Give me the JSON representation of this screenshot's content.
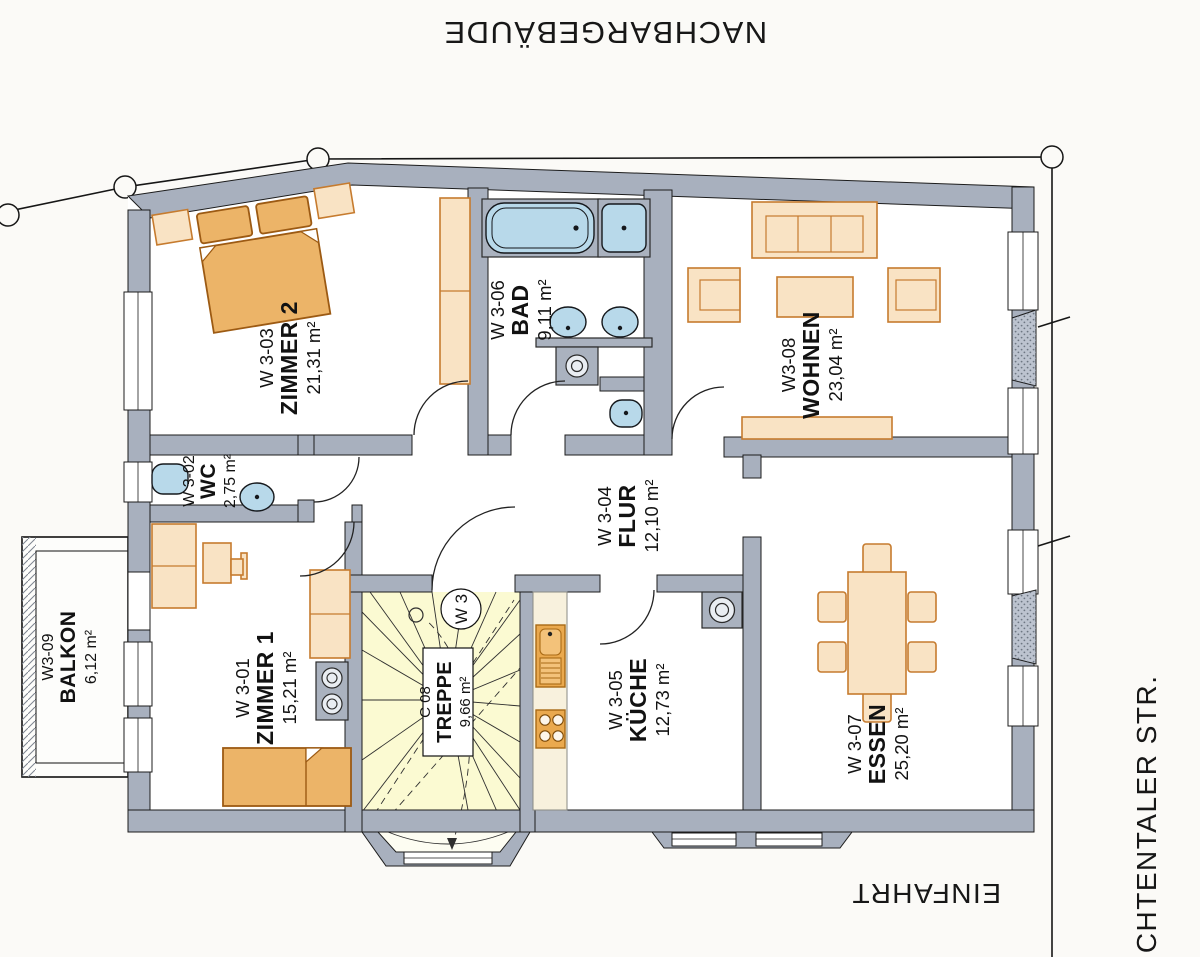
{
  "site": {
    "neighbor_label": "NACHBARGEBÄUDE",
    "street_label": "LICHTENTALER STR.",
    "driveway_label": "EINFAHRT"
  },
  "unit": {
    "badge": "W 3"
  },
  "rooms": {
    "zimmer2": {
      "code": "W 3-03",
      "name": "ZIMMER 2",
      "area": "21,31 m²"
    },
    "bad": {
      "code": "W 3-06",
      "name": "BAD",
      "area": "9,11 m²"
    },
    "wohnen": {
      "code": "W3-08",
      "name": "WOHNEN",
      "area": "23,04 m²"
    },
    "wc": {
      "code": "W 3-02",
      "name": "WC",
      "area": "2,75 m²"
    },
    "flur": {
      "code": "W 3-04",
      "name": "FLUR",
      "area": "12,10 m²"
    },
    "zimmer1": {
      "code": "W 3-01",
      "name": "ZIMMER 1",
      "area": "15,21 m²"
    },
    "treppe": {
      "code": "C 08",
      "name": "TREPPE",
      "area": "9,66 m²"
    },
    "kueche": {
      "code": "W 3-05",
      "name": "KÜCHE",
      "area": "12,73 m²"
    },
    "essen": {
      "code": "W 3-07",
      "name": "ESSEN",
      "area": "25,20 m²"
    },
    "balkon": {
      "code": "W3-09",
      "name": "BALKON",
      "area": "6,12 m²"
    }
  },
  "colors": {
    "paper": "#fbfaf7",
    "wall": "#a8b0be",
    "wall-dark": "#bcc3cf",
    "furn-fill": "#f9e3c4",
    "furn-stroke": "#c67b2e",
    "bed-fill": "#ecb468",
    "bed-stroke": "#9c5a13",
    "blue-fill": "#b8d9ea",
    "stair-fill": "#fbfad2",
    "counter-fill": "#f8f1dd",
    "appliance-fill": "#eaa94e",
    "appliance-stroke": "#a96a15",
    "fixture-gray": "#aab2bf",
    "ink": "#121212"
  }
}
